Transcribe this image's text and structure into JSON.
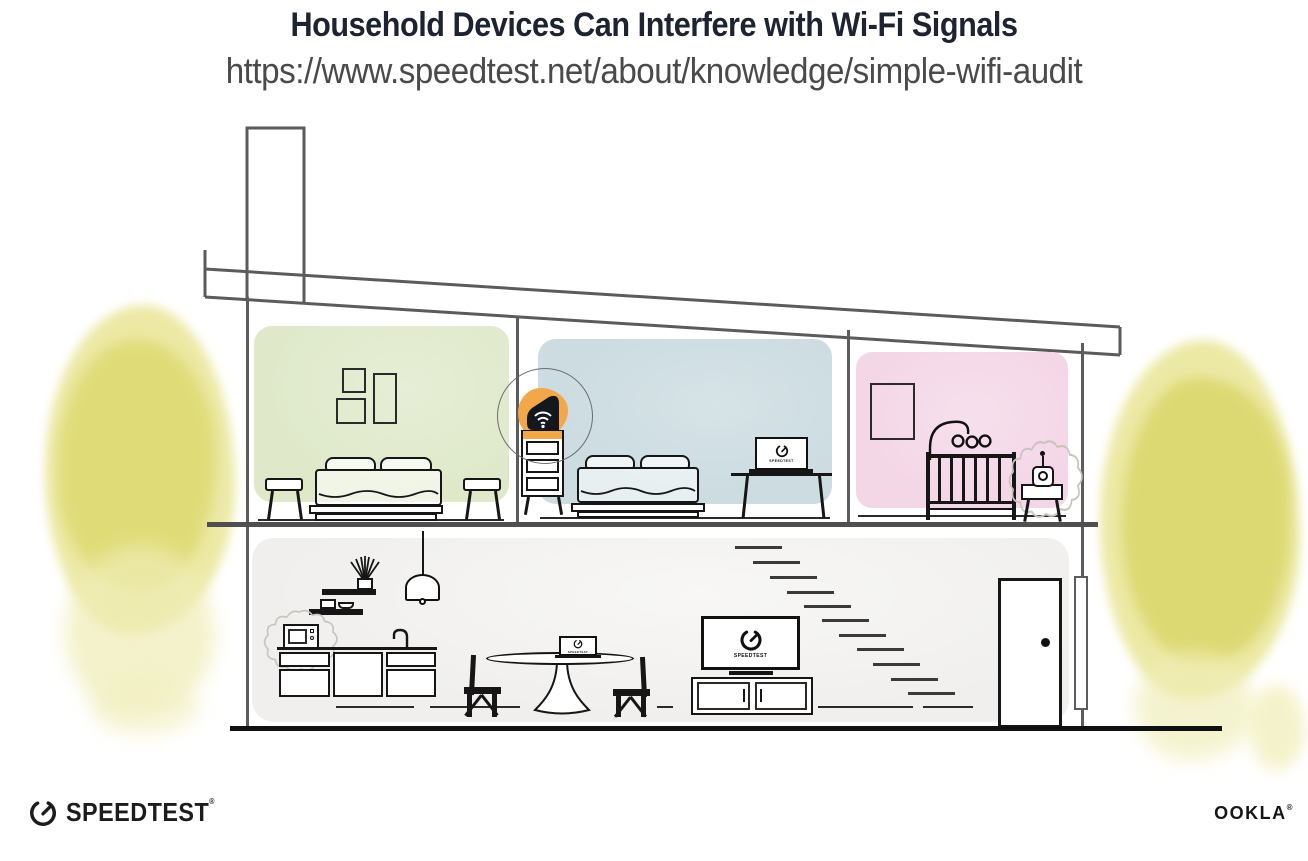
{
  "header": {
    "title": "Household Devices Can Interfere with Wi-Fi Signals",
    "url": "https://www.speedtest.net/about/knowledge/simple-wifi-audit"
  },
  "device_screens": {
    "bedroom_laptop_label": "SPEEDTEST",
    "dining_laptop_label": "SPEEDTEST",
    "tv_label": "SPEEDTEST"
  },
  "footer": {
    "speedtest_wordmark": "SPEEDTEST",
    "speedtest_mark": "®",
    "ookla_wordmark": "OOKLA",
    "ookla_mark": "®"
  },
  "colors": {
    "title_text": "#1d2330",
    "url_text": "#4a4a4a",
    "architecture_line": "#5c5c5c",
    "furniture_line": "#161616",
    "room_green": "#dfe9ca",
    "room_blue": "#ccdce1",
    "room_pink": "#f4d7e7",
    "lower_floor_gray": "#f0efed",
    "router_highlight_orange": "#f2a74b",
    "router_body": "#14181d",
    "bush_yellow": "#e0dd78",
    "interference_outline": "#c9c3bd"
  },
  "icons": {
    "speedtest_gauge_icon": "open ring gauge with needle",
    "wifi_icon": "three wifi arcs over dot",
    "interference_burst_icon": "wavy starburst outline",
    "door_knob_icon": "solid dot"
  }
}
